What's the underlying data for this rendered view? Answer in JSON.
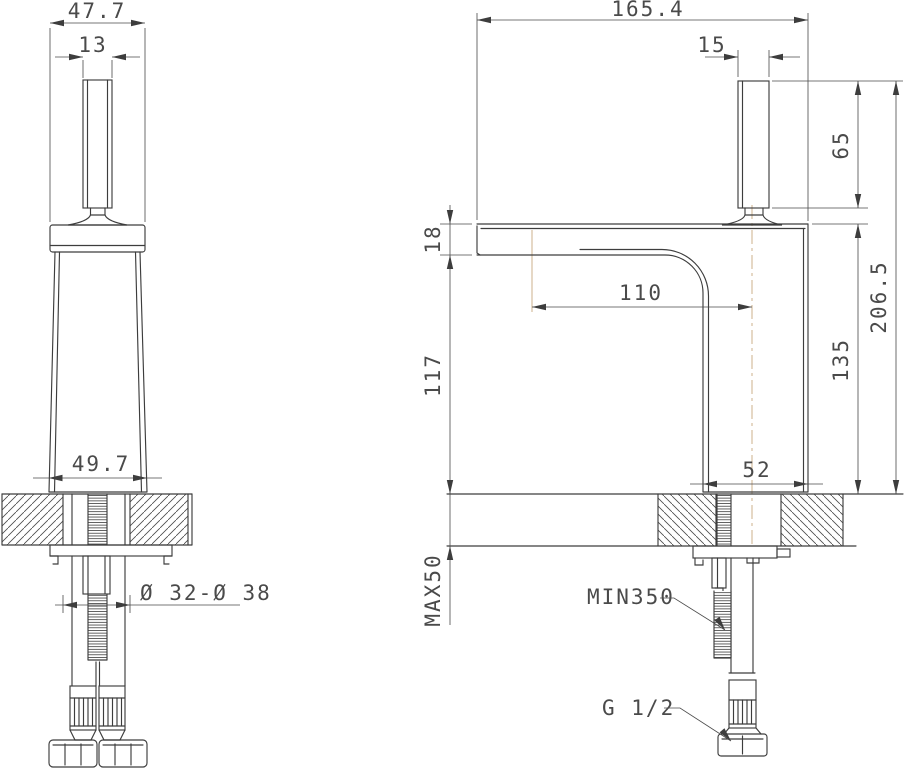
{
  "drawing": {
    "title": "basin faucet installation technical drawing",
    "views": {
      "front": {
        "name": "front view",
        "dims": {
          "cap_width": "47.7",
          "handle_width": "13",
          "base_width": "49.7",
          "hole_diameter": "Ø 32-Ø 38"
        }
      },
      "side": {
        "name": "side view",
        "dims": {
          "overall_depth": "165.4",
          "handle_thickness": "15",
          "handle_height": "65",
          "overall_height": "206.5",
          "spout_thickness": "18",
          "spout_reach": "110",
          "spout_clearance": "117",
          "body_height": "135",
          "body_depth": "52",
          "max_counter_thickness": "MAX50",
          "min_hose_length": "MIN350",
          "thread_size": "G 1/2"
        }
      }
    },
    "colors": {
      "line": "#3d3d3d",
      "dimension": "#4a4a4a",
      "centerline": "#c9a87f",
      "background": "#ffffff"
    }
  }
}
